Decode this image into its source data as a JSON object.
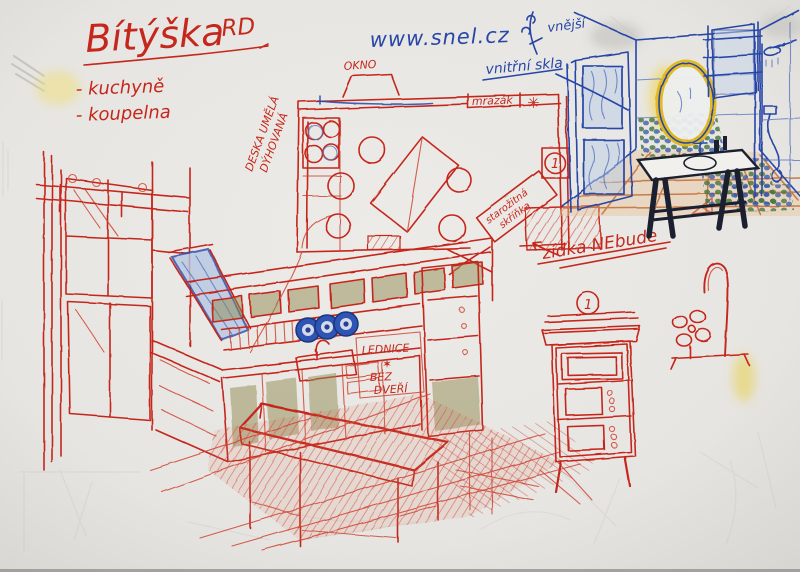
{
  "title_block": {
    "title": "Bítýška",
    "suffix": "RD",
    "items": [
      "- kuchyně",
      "- koupelna"
    ]
  },
  "url": "www.snel.cz",
  "floor_plan": {
    "window_label": "OKNO",
    "freezer_label": "mrazák",
    "snowflake_symbol": "✳",
    "material_note_line1": "DESKA UMĚLÁ",
    "material_note_line2": "DÝHOVANÁ",
    "antique_note_line1": "starožitná",
    "antique_note_line2": "skříňka",
    "marker_number": "1"
  },
  "annotations": {
    "wall_note": "zídka NEbude",
    "fridge_note_line1": "LEDNICE",
    "fridge_note_star": "✶",
    "fridge_note_line2": "BEZ",
    "fridge_note_line3": "DVEŘÍ",
    "glass_note_top": "vnější",
    "glass_note_bottom": "vnitřní skla"
  },
  "cabinet": {
    "marker_number": "1"
  },
  "colors": {
    "paper": "#e7e5e1",
    "red_pen": "#c5271c",
    "blue_pen": "#2746a8",
    "olive_crayon": "#8f8a4f",
    "yellow_crayon": "#e8c829",
    "terracotta_crayon": "#c5773f",
    "mosaic_green": "#46763c",
    "dark_table": "#1b2030"
  }
}
